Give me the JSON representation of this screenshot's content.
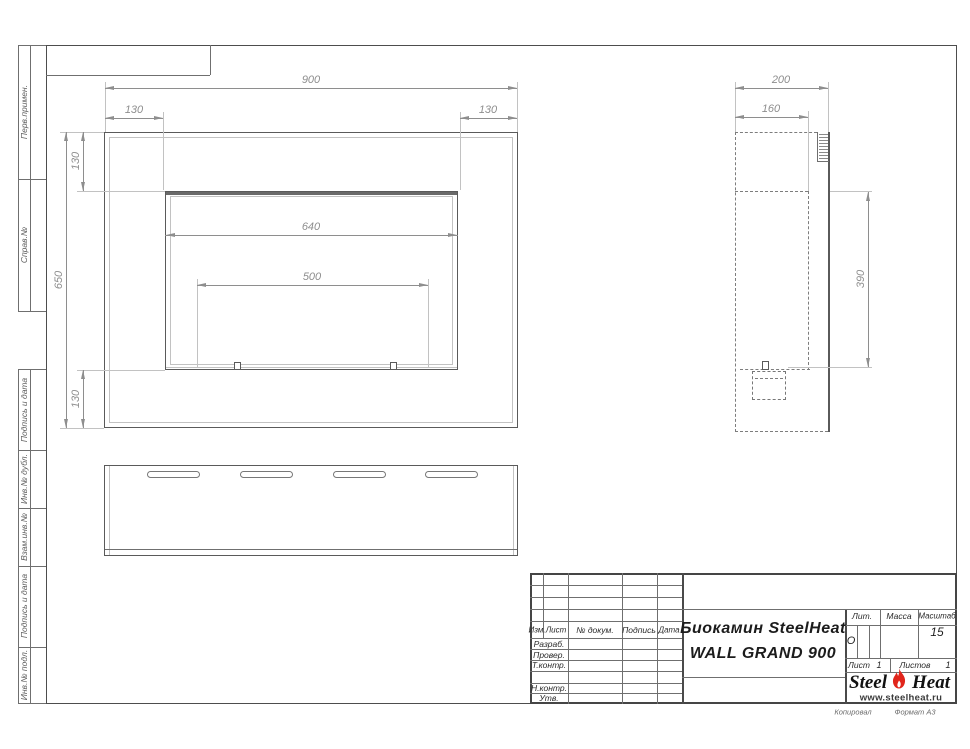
{
  "margin_labels": {
    "top": [
      "Перв.примен.",
      "Справ.№"
    ],
    "bottom": [
      "Подпись и дата",
      "Инв.№ дубл.",
      "Взам.инв.№",
      "Подпись и дата",
      "Инв.№ подл."
    ]
  },
  "front_view": {
    "dim_width": "900",
    "dim_left": "130",
    "dim_right": "130",
    "dim_top": "130",
    "dim_height": "650",
    "dim_bottom": "130",
    "dim_opening": "640",
    "dim_burner": "500"
  },
  "side_view": {
    "dim_depth": "200",
    "dim_inner_depth": "160",
    "dim_opening_height": "390"
  },
  "title_block": {
    "rev_cols": [
      "Изм.",
      "Лист",
      "№ докум.",
      "Подпись",
      "Дата"
    ],
    "sign_rows": [
      "Разраб.",
      "Провер.",
      "Т.контр.",
      "Н.контр.",
      "Утв."
    ],
    "doc_title_line1": "Биокамин SteelHeat",
    "doc_title_line2": "WALL GRAND 900",
    "lit_label": "Лит.",
    "lit_value": "О",
    "mass_label": "Масса",
    "scale_label": "Масштаб",
    "scale_value": "15",
    "sheet_label": "Лист",
    "sheet_number": "1",
    "sheets_label": "Листов",
    "sheets_total": "1",
    "logo_steel": "Steel",
    "logo_heat": "Heat",
    "logo_url": "www.steelheat.ru",
    "footer_copied": "Копировал",
    "footer_format": "Формат А3"
  },
  "colors": {
    "line": "#6f6f6f",
    "dim": "#8e8e8e",
    "flame_red": "#e1251b"
  }
}
